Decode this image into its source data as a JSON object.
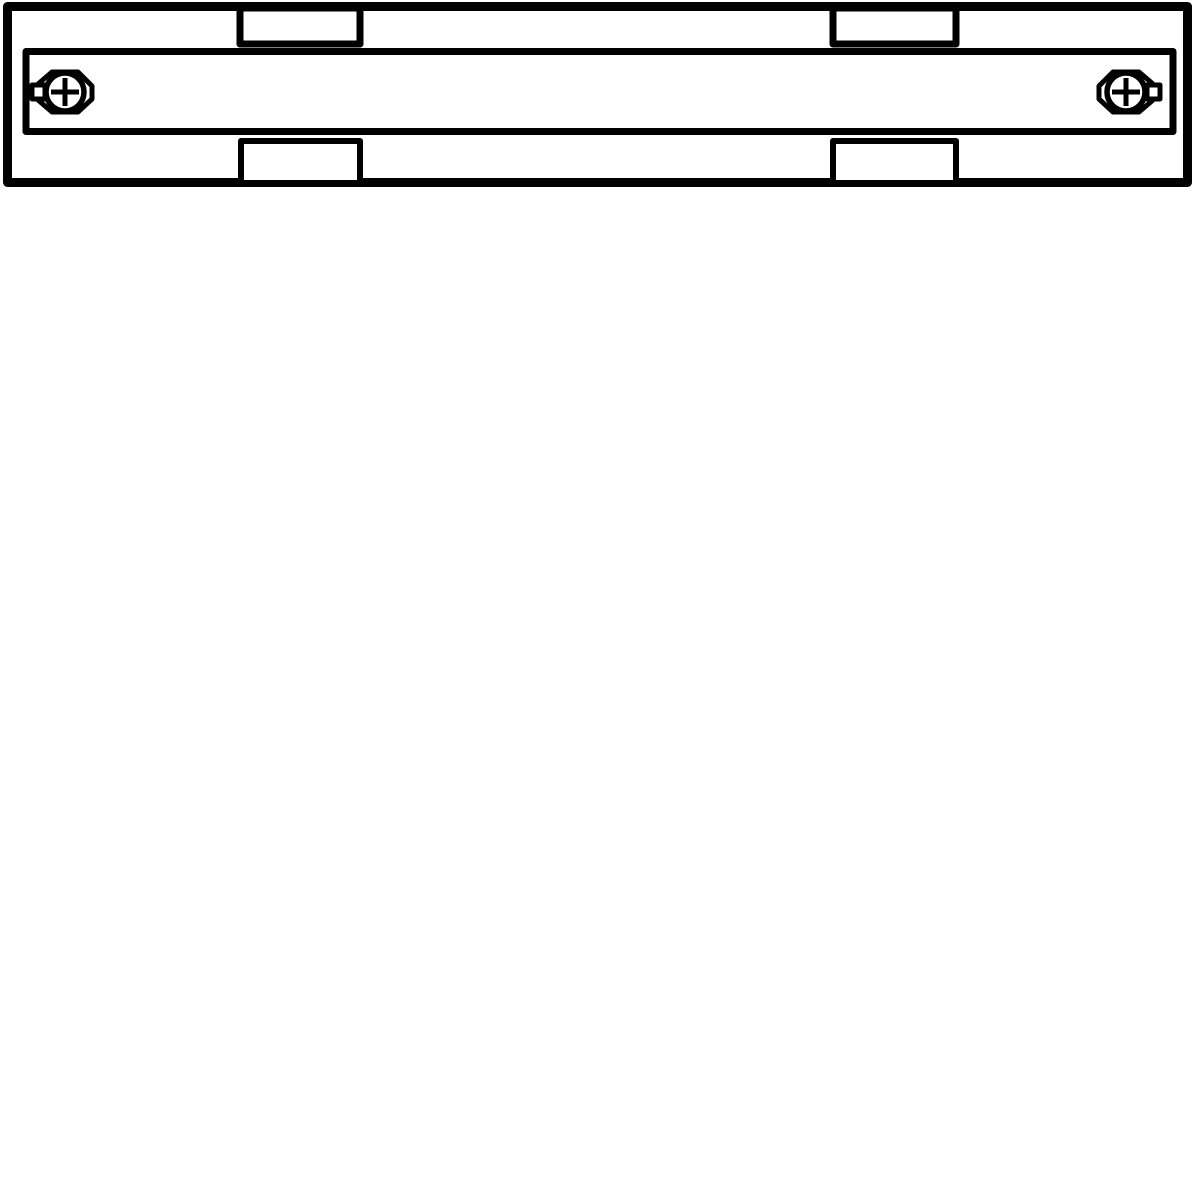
{
  "page": {
    "width": 1200,
    "height": 1200,
    "background_color": "#ffffff"
  },
  "drawing": {
    "name": "track-connector-technical-drawing",
    "line_color": "#000000",
    "fill_color": "#ffffff",
    "viewbox": "0 0 1200 1200",
    "shapes": [
      {
        "type": "rect",
        "name": "outer-housing-outline",
        "x": 7.5,
        "y": 6.5,
        "w": 1180,
        "h": 176,
        "stroke_width": 9,
        "filled": true
      },
      {
        "type": "rect",
        "name": "rail-body",
        "x": 26,
        "y": 51.5,
        "w": 1147,
        "h": 80,
        "stroke_width": 7,
        "filled": true
      },
      {
        "type": "rect",
        "name": "top-left-tab",
        "x": 240,
        "y": 8,
        "w": 120,
        "h": 36,
        "stroke_width": 7,
        "filled": true
      },
      {
        "type": "rect",
        "name": "top-right-tab",
        "x": 833,
        "y": 8,
        "w": 123,
        "h": 36,
        "stroke_width": 7,
        "filled": true
      },
      {
        "type": "rect",
        "name": "bottom-left-tab",
        "x": 241,
        "y": 141,
        "w": 119,
        "h": 42,
        "stroke_width": 6,
        "filled": true
      },
      {
        "type": "rect",
        "name": "bottom-right-tab",
        "x": 833,
        "y": 141,
        "w": 123,
        "h": 42,
        "stroke_width": 6,
        "filled": true
      },
      {
        "type": "polygon",
        "name": "left-screw-nut-outline",
        "points": "38,84 52,72 78,72 92,86 92,99 78,112 52,112 38,100",
        "stroke_width": 5,
        "filled": true
      },
      {
        "type": "rect",
        "name": "left-screw-clamp-plate",
        "x": 32,
        "y": 85,
        "w": 13,
        "h": 14,
        "stroke_width": 5,
        "filled": true
      },
      {
        "type": "circle",
        "name": "left-screw-head",
        "cx": 65,
        "cy": 92,
        "r": 19,
        "stroke_width": 5.5,
        "filled": true
      },
      {
        "type": "line",
        "name": "left-screw-cross-slot-h",
        "x1": 51,
        "y1": 92,
        "x2": 79,
        "y2": 92,
        "stroke_width": 5
      },
      {
        "type": "line",
        "name": "left-screw-cross-slot-v",
        "x1": 65,
        "y1": 78,
        "x2": 65,
        "y2": 106,
        "stroke_width": 5
      },
      {
        "type": "polygon",
        "name": "right-screw-nut-outline",
        "points": "1153,84 1139,72 1113,72 1099,86 1099,99 1113,112 1139,112 1153,100",
        "stroke_width": 5,
        "filled": true
      },
      {
        "type": "rect",
        "name": "right-screw-clamp-plate",
        "x": 1147,
        "y": 85,
        "w": 13,
        "h": 14,
        "stroke_width": 5,
        "filled": true
      },
      {
        "type": "circle",
        "name": "right-screw-head",
        "cx": 1126,
        "cy": 92,
        "r": 19,
        "stroke_width": 5.5,
        "filled": true
      },
      {
        "type": "line",
        "name": "right-screw-cross-slot-h",
        "x1": 1112,
        "y1": 92,
        "x2": 1140,
        "y2": 92,
        "stroke_width": 5
      },
      {
        "type": "line",
        "name": "right-screw-cross-slot-v",
        "x1": 1126,
        "y1": 78,
        "x2": 1126,
        "y2": 106,
        "stroke_width": 5
      }
    ]
  }
}
